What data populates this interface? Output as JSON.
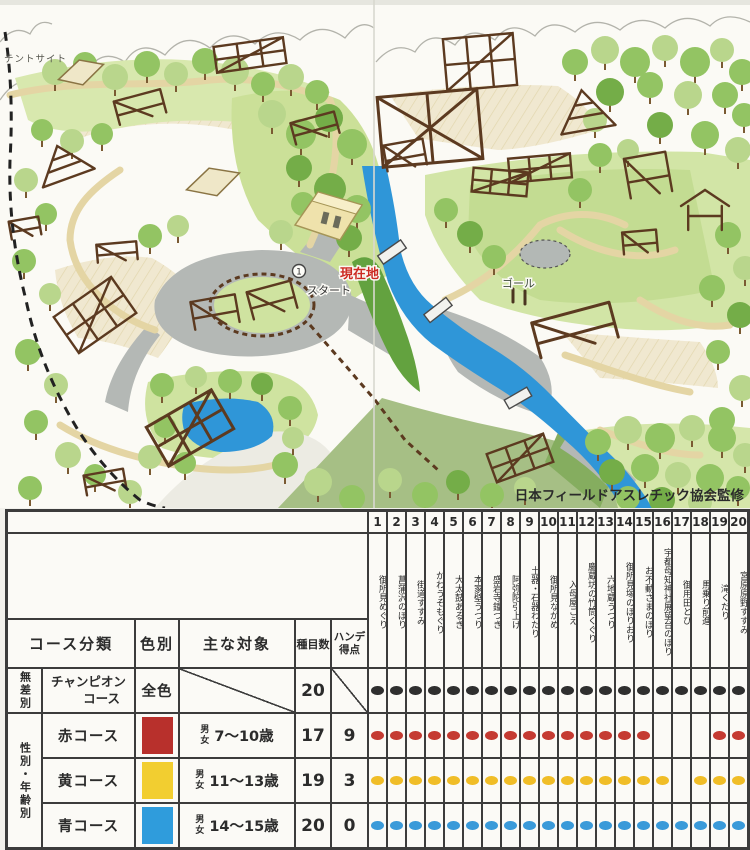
{
  "map": {
    "labels": {
      "tent_site": "テントサイト",
      "current": "現在地",
      "start": "スタート",
      "start_no": "1",
      "goal": "ゴール",
      "credit": "日本フィールドアスレチック協会監修"
    },
    "colors": {
      "river": "#2f96d8",
      "pavement": "#b4b8b5",
      "grass": "#d2e5a6",
      "structure": "#5c3a20",
      "current_red": "#cc2a22"
    }
  },
  "table": {
    "column_headers": {
      "course_class": "コース分類",
      "color": "色別",
      "target": "主な対象",
      "events": "種目数",
      "handicap_l1": "ハンデ",
      "handicap_l2": "得点"
    },
    "stations": [
      {
        "no": "1",
        "name": "御所見めぐり"
      },
      {
        "no": "2",
        "name": "菖蒲沢のぼり"
      },
      {
        "no": "3",
        "name": "街道すすみ"
      },
      {
        "no": "4",
        "name": "かわうそもぐり"
      },
      {
        "no": "5",
        "name": "大太鼓あるき"
      },
      {
        "no": "6",
        "name": "本家壁うつり"
      },
      {
        "no": "7",
        "name": "盛岩寺鐘つき"
      },
      {
        "no": "8",
        "name": "阿弥陀引上げ"
      },
      {
        "no": "9",
        "name": "土器・石器わたり"
      },
      {
        "no": "10",
        "name": "御所見ながめ"
      },
      {
        "no": "11",
        "name": "入母屋ごえ"
      },
      {
        "no": "12",
        "name": "慶蔵坊の竹筒くぐり"
      },
      {
        "no": "13",
        "name": "六地蔵うつり"
      },
      {
        "no": "14",
        "name": "御所見塚のぼりおり"
      },
      {
        "no": "15",
        "name": "お不動さまのぼり"
      },
      {
        "no": "16",
        "name": "宇都母知神社展望台のぼり"
      },
      {
        "no": "17",
        "name": "御用田とび"
      },
      {
        "no": "18",
        "name": "馬乗り前進"
      },
      {
        "no": "19",
        "name": "滝くだり"
      },
      {
        "no": "20",
        "name": "宮原原野すすみ"
      }
    ],
    "rows": [
      {
        "group": "無差別",
        "course_l1": "チャンピオン",
        "course_l2": "コース",
        "color_label": "全色",
        "swatch": "",
        "target_gender": "",
        "target_age": "",
        "events": "20",
        "handicap": "",
        "dot": "#2f2f2f",
        "dots": [
          1,
          2,
          3,
          4,
          5,
          6,
          7,
          8,
          9,
          10,
          11,
          12,
          13,
          14,
          15,
          16,
          17,
          18,
          19,
          20
        ]
      },
      {
        "group": "性別・年齢別",
        "course_l1": "赤コース",
        "course_l2": "",
        "color_label": "",
        "swatch": "#b8302c",
        "target_gender": "男女",
        "target_age": "7〜10歳",
        "events": "17",
        "handicap": "9",
        "dot": "#c53b32",
        "dots": [
          1,
          2,
          3,
          4,
          5,
          6,
          7,
          8,
          9,
          10,
          11,
          12,
          13,
          14,
          15,
          19,
          20
        ]
      },
      {
        "group": "",
        "course_l1": "黄コース",
        "course_l2": "",
        "color_label": "",
        "swatch": "#f2ce30",
        "target_gender": "男女",
        "target_age": "11〜13歳",
        "events": "19",
        "handicap": "3",
        "dot": "#f0bd27",
        "dots": [
          1,
          2,
          3,
          4,
          5,
          6,
          7,
          8,
          9,
          10,
          11,
          12,
          13,
          14,
          15,
          16,
          18,
          19,
          20
        ]
      },
      {
        "group": "",
        "course_l1": "青コース",
        "course_l2": "",
        "color_label": "",
        "swatch": "#2f9cdc",
        "target_gender": "男女",
        "target_age": "14〜15歳",
        "events": "20",
        "handicap": "0",
        "dot": "#3a9ad9",
        "dots": [
          1,
          2,
          3,
          4,
          5,
          6,
          7,
          8,
          9,
          10,
          11,
          12,
          13,
          14,
          15,
          16,
          17,
          18,
          19,
          20
        ]
      }
    ]
  }
}
